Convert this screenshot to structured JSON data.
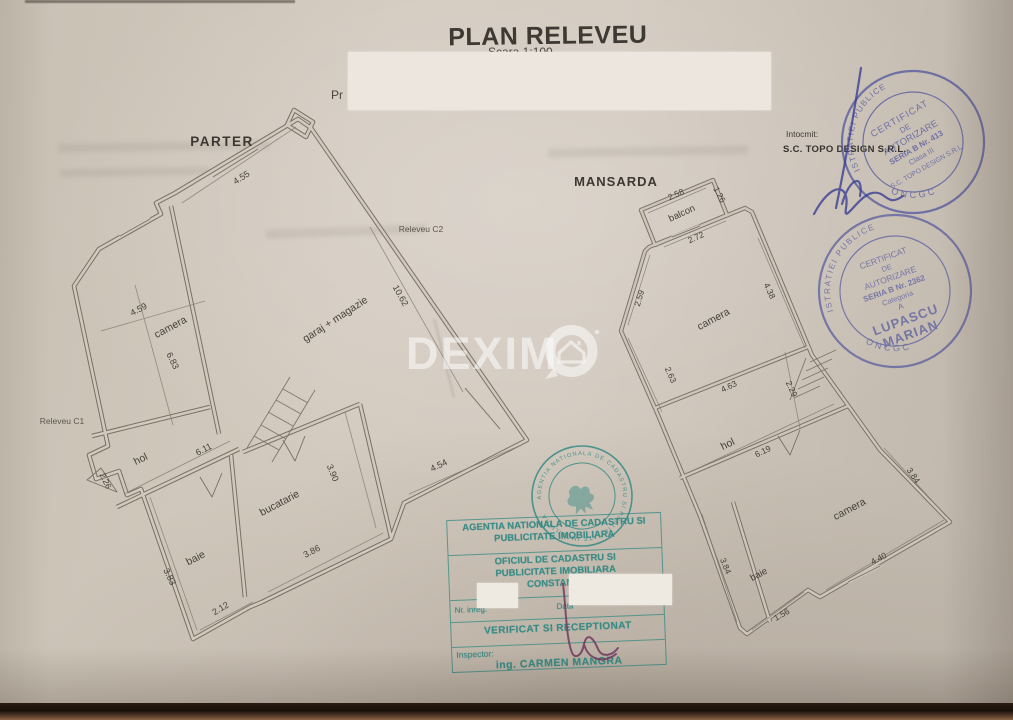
{
  "title": "PLAN RELEVEU IMOBIL",
  "scale_note": "Scara 1:100",
  "partial_text": "Pr",
  "prepared_by": {
    "label": "Intocmit:",
    "company": "S.C. TOPO DESIGN S.R.L."
  },
  "watermark": {
    "brand": "DEXIMO",
    "text_part": "DEXIM"
  },
  "parter": {
    "title": "PARTER",
    "releveu_c1": "Releveu C1",
    "releveu_c2": "Releveu C2",
    "rooms": {
      "camera": "camera",
      "hol": "hol",
      "baie": "baie",
      "bucatarie": "bucatarie",
      "garaj": "garaj + magazie"
    },
    "dims": {
      "top": "4.55",
      "camera_w": "4.59",
      "camera_h": "6.83",
      "garaj_len": "10.62",
      "garaj_bottom": "4.54",
      "hol_len": "6.11",
      "entry": "2.26",
      "bucatarie_h": "3.90",
      "bucatarie_w": "3.86",
      "baie_h": "3.83",
      "baie_w": "2.12"
    }
  },
  "mansarda": {
    "title": "MANSARDA",
    "rooms": {
      "balcon": "balcon",
      "camera_sus": "camera",
      "hol": "hol",
      "camera_jos": "camera",
      "baie": "baie"
    },
    "dims": {
      "balcon_w": "2.58",
      "balcon_h": "1.26",
      "top_w": "2.72",
      "left_up": "2.59",
      "right_up": "4.38",
      "left_mid": "2.63",
      "mid_w": "4.63",
      "stair": "2.29",
      "hol_len": "6.19",
      "baie_h": "3.84",
      "baie_w": "1.56",
      "camera_w": "4.40",
      "camera_h": "3.84"
    }
  },
  "stamps": {
    "minister_1": {
      "ring": "MINISTERUL ADMINISTRATIEI PUBLICE",
      "bottom": "ONCGC",
      "l1": "CERTIFICAT",
      "l2": "DE",
      "l3": "AUTORIZARE",
      "l4": "SERIA B Nr. 413",
      "l5": "Clasa III",
      "l6": "S.C. TOPO DESIGN S.R.L."
    },
    "minister_2": {
      "ring": "MINISTERUL ADMINISTRATIEI PUBLICE",
      "bottom": "ONCGC",
      "l1": "CERTIFICAT",
      "l2": "DE",
      "l3": "AUTORIZARE",
      "l4": "SERIA B Nr. 2362",
      "l5": "Categoria",
      "l6": "A",
      "l7": "LUPASCU",
      "l8": "MARIAN"
    },
    "cadastru_seal_ring": "AGENTIA NATIONALA DE CADASTRU SI PUBLICITATE IMOBILIARA",
    "cadastru_box": {
      "l1": "AGENTIA NATIONALA DE CADASTRU SI",
      "l2": "PUBLICITATE IMOBILIARA",
      "l3": "OFICIUL DE CADASTRU SI",
      "l4": "PUBLICITATE IMOBILIARA",
      "l5": "CONSTANTA",
      "nr_label": "Nr. inreg.",
      "data_label": "Data",
      "verificat": "VERIFICAT SI RECEPTIONAT",
      "inspector_label": "Inspector:",
      "inspector_name": "ing. CARMEN MANGRA"
    }
  },
  "colors": {
    "paper": "#cfc6ba",
    "ink": "#46403a",
    "wall": "#6a6157",
    "stamp_blue": "#565a9e",
    "stamp_teal": "#2b8782",
    "signature_blue": "#3b3f93",
    "signature_purple": "#74395f"
  }
}
